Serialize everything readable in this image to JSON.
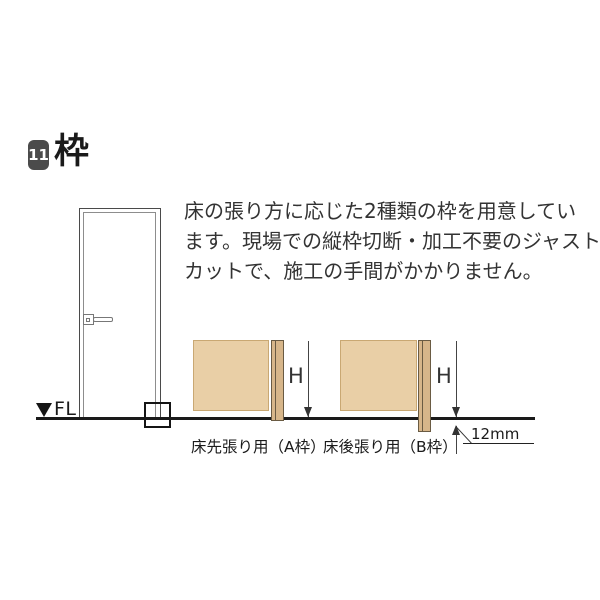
{
  "header": {
    "badge": "11",
    "title": "枠"
  },
  "description": {
    "full_text": "床の張り方に応じた2種類の枠を用意しています。現場での縦枠切断・加工不要のジャストカットで、施工の手間がかかりません。",
    "lines": [
      "床の張り方に応じた2種類の枠を用意してい",
      "ます。現場での縦枠切断・加工不要のジャスト",
      "カットで、施工の手間がかかりません。"
    ]
  },
  "floor": {
    "label": "FL"
  },
  "diagram_a": {
    "dimension_label": "H",
    "caption": "床先張り用（A枠）"
  },
  "diagram_b": {
    "dimension_label": "H",
    "caption": "床後張り用（B枠）",
    "offset_label": "12mm"
  },
  "colors": {
    "badge_bg": "#4b4b4b",
    "wall_fill": "#e9cfa6",
    "frame_fill": "#d7b68a",
    "floor_line": "#1a1a1a"
  }
}
